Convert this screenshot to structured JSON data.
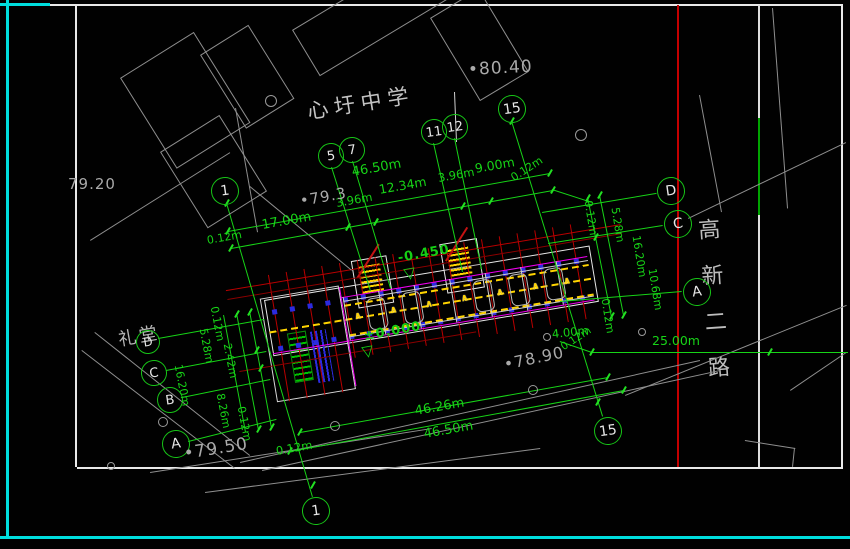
{
  "palette": {
    "cyan": "#00dede",
    "frame_white": "#e9e9e9",
    "site_gray": "#8f8f8f",
    "dim_green": "#17d417",
    "bright_green": "#22e022",
    "grid_red": "#b90000",
    "boundary_red": "#c40000",
    "wall_yellow": "#ffd400",
    "magenta": "#f000f0",
    "column_blue": "#2b2bdf",
    "text_gray": "#a9a9a9"
  },
  "drawing": {
    "school_label": "心圩中学",
    "auditorium_label": "礼堂",
    "road_label_chars": [
      "高",
      "新",
      "二",
      "路"
    ],
    "elevation_markers": [
      {
        "text": "-0.450",
        "x": 398,
        "y": 251,
        "rot": -10
      },
      {
        "text": "±0.000",
        "x": 364,
        "y": 329,
        "rot": -10
      }
    ],
    "elevation_triangles": [
      {
        "x": 404,
        "y": 267,
        "rot": -10
      },
      {
        "x": 362,
        "y": 345,
        "rot": -10
      }
    ],
    "spot_elevations": [
      {
        "text": "•80.40",
        "x": 468,
        "y": 60,
        "rot": -3,
        "size": 17
      },
      {
        "text": "79.20",
        "x": 68,
        "y": 175,
        "rot": 0,
        "size": 15
      },
      {
        "text": "•79.3",
        "x": 300,
        "y": 192,
        "rot": -10,
        "size": 15
      },
      {
        "text": "•78.90",
        "x": 504,
        "y": 355,
        "rot": -12,
        "size": 16
      },
      {
        "text": "•79.50",
        "x": 184,
        "y": 444,
        "rot": -9,
        "size": 17
      }
    ],
    "dim_labels": [
      {
        "text": "46.50m",
        "x": 352,
        "y": 165,
        "rot": -10,
        "size": 13
      },
      {
        "text": "0.12m",
        "x": 207,
        "y": 234,
        "rot": -10,
        "size": 11
      },
      {
        "text": "17.00m",
        "x": 262,
        "y": 218,
        "rot": -10,
        "size": 13
      },
      {
        "text": "3.96m",
        "x": 336,
        "y": 196,
        "rot": -10,
        "size": 11.5
      },
      {
        "text": "12.34m",
        "x": 379,
        "y": 182,
        "rot": -10,
        "size": 12.5
      },
      {
        "text": "3.96m",
        "x": 438,
        "y": 171,
        "rot": -10,
        "size": 11.5
      },
      {
        "text": "9.00m",
        "x": 475,
        "y": 161,
        "rot": -10,
        "size": 12.5
      },
      {
        "text": "0.12m",
        "x": 512,
        "y": 172,
        "rot": -33,
        "size": 11
      },
      {
        "text": "46.26m",
        "x": 415,
        "y": 404,
        "rot": -10,
        "size": 13
      },
      {
        "text": "46.50m",
        "x": 424,
        "y": 427,
        "rot": -10,
        "size": 13
      },
      {
        "text": "0.12m",
        "x": 276,
        "y": 444,
        "rot": -10,
        "size": 11.5
      },
      {
        "text": "4.00m",
        "x": 552,
        "y": 327,
        "rot": -6,
        "size": 11.5
      },
      {
        "text": "0.12m",
        "x": 562,
        "y": 342,
        "rot": -33,
        "size": 10.5
      },
      {
        "text": "25.00m",
        "x": 652,
        "y": 333,
        "rot": 0,
        "size": 12.5
      },
      {
        "text": "0.12m",
        "x": 588,
        "y": 194,
        "rot": 81,
        "size": 11
      },
      {
        "text": "5.28m",
        "x": 615,
        "y": 201,
        "rot": 81,
        "size": 11
      },
      {
        "text": "16.20m",
        "x": 636,
        "y": 229,
        "rot": 81,
        "size": 11
      },
      {
        "text": "10.68m",
        "x": 652,
        "y": 262,
        "rot": 81,
        "size": 11
      },
      {
        "text": "0.12m",
        "x": 605,
        "y": 292,
        "rot": 81,
        "size": 11
      },
      {
        "text": "0.12m",
        "x": 214,
        "y": 300,
        "rot": 79,
        "size": 11
      },
      {
        "text": "5.28m",
        "x": 203,
        "y": 322,
        "rot": 79,
        "size": 11
      },
      {
        "text": "2.42m",
        "x": 227,
        "y": 337,
        "rot": 79,
        "size": 11
      },
      {
        "text": "16.20m",
        "x": 178,
        "y": 358,
        "rot": 79,
        "size": 11
      },
      {
        "text": "8.26m",
        "x": 220,
        "y": 387,
        "rot": 79,
        "size": 11
      },
      {
        "text": "0.12m",
        "x": 241,
        "y": 400,
        "rot": 79,
        "size": 11
      }
    ],
    "grid_bubbles": [
      {
        "label": "5",
        "cx": 330,
        "cy": 155,
        "r": 12
      },
      {
        "label": "7",
        "cx": 351,
        "cy": 149,
        "r": 12
      },
      {
        "label": "11",
        "cx": 433,
        "cy": 131,
        "r": 12
      },
      {
        "label": "12",
        "cx": 454,
        "cy": 126,
        "r": 12
      },
      {
        "label": "15",
        "cx": 511,
        "cy": 108,
        "r": 13
      },
      {
        "label": "1",
        "cx": 224,
        "cy": 190,
        "r": 13
      },
      {
        "label": "D",
        "cx": 670,
        "cy": 190,
        "r": 13
      },
      {
        "label": "C",
        "cx": 677,
        "cy": 223,
        "r": 13
      },
      {
        "label": "A",
        "cx": 696,
        "cy": 291,
        "r": 13
      },
      {
        "label": "D",
        "cx": 147,
        "cy": 341,
        "r": 11
      },
      {
        "label": "C",
        "cx": 153,
        "cy": 372,
        "r": 12
      },
      {
        "label": "B",
        "cx": 169,
        "cy": 399,
        "r": 12
      },
      {
        "label": "A",
        "cx": 175,
        "cy": 443,
        "r": 13
      },
      {
        "label": "1",
        "cx": 315,
        "cy": 510,
        "r": 13
      },
      {
        "label": "15",
        "cx": 607,
        "cy": 430,
        "r": 13
      }
    ]
  }
}
